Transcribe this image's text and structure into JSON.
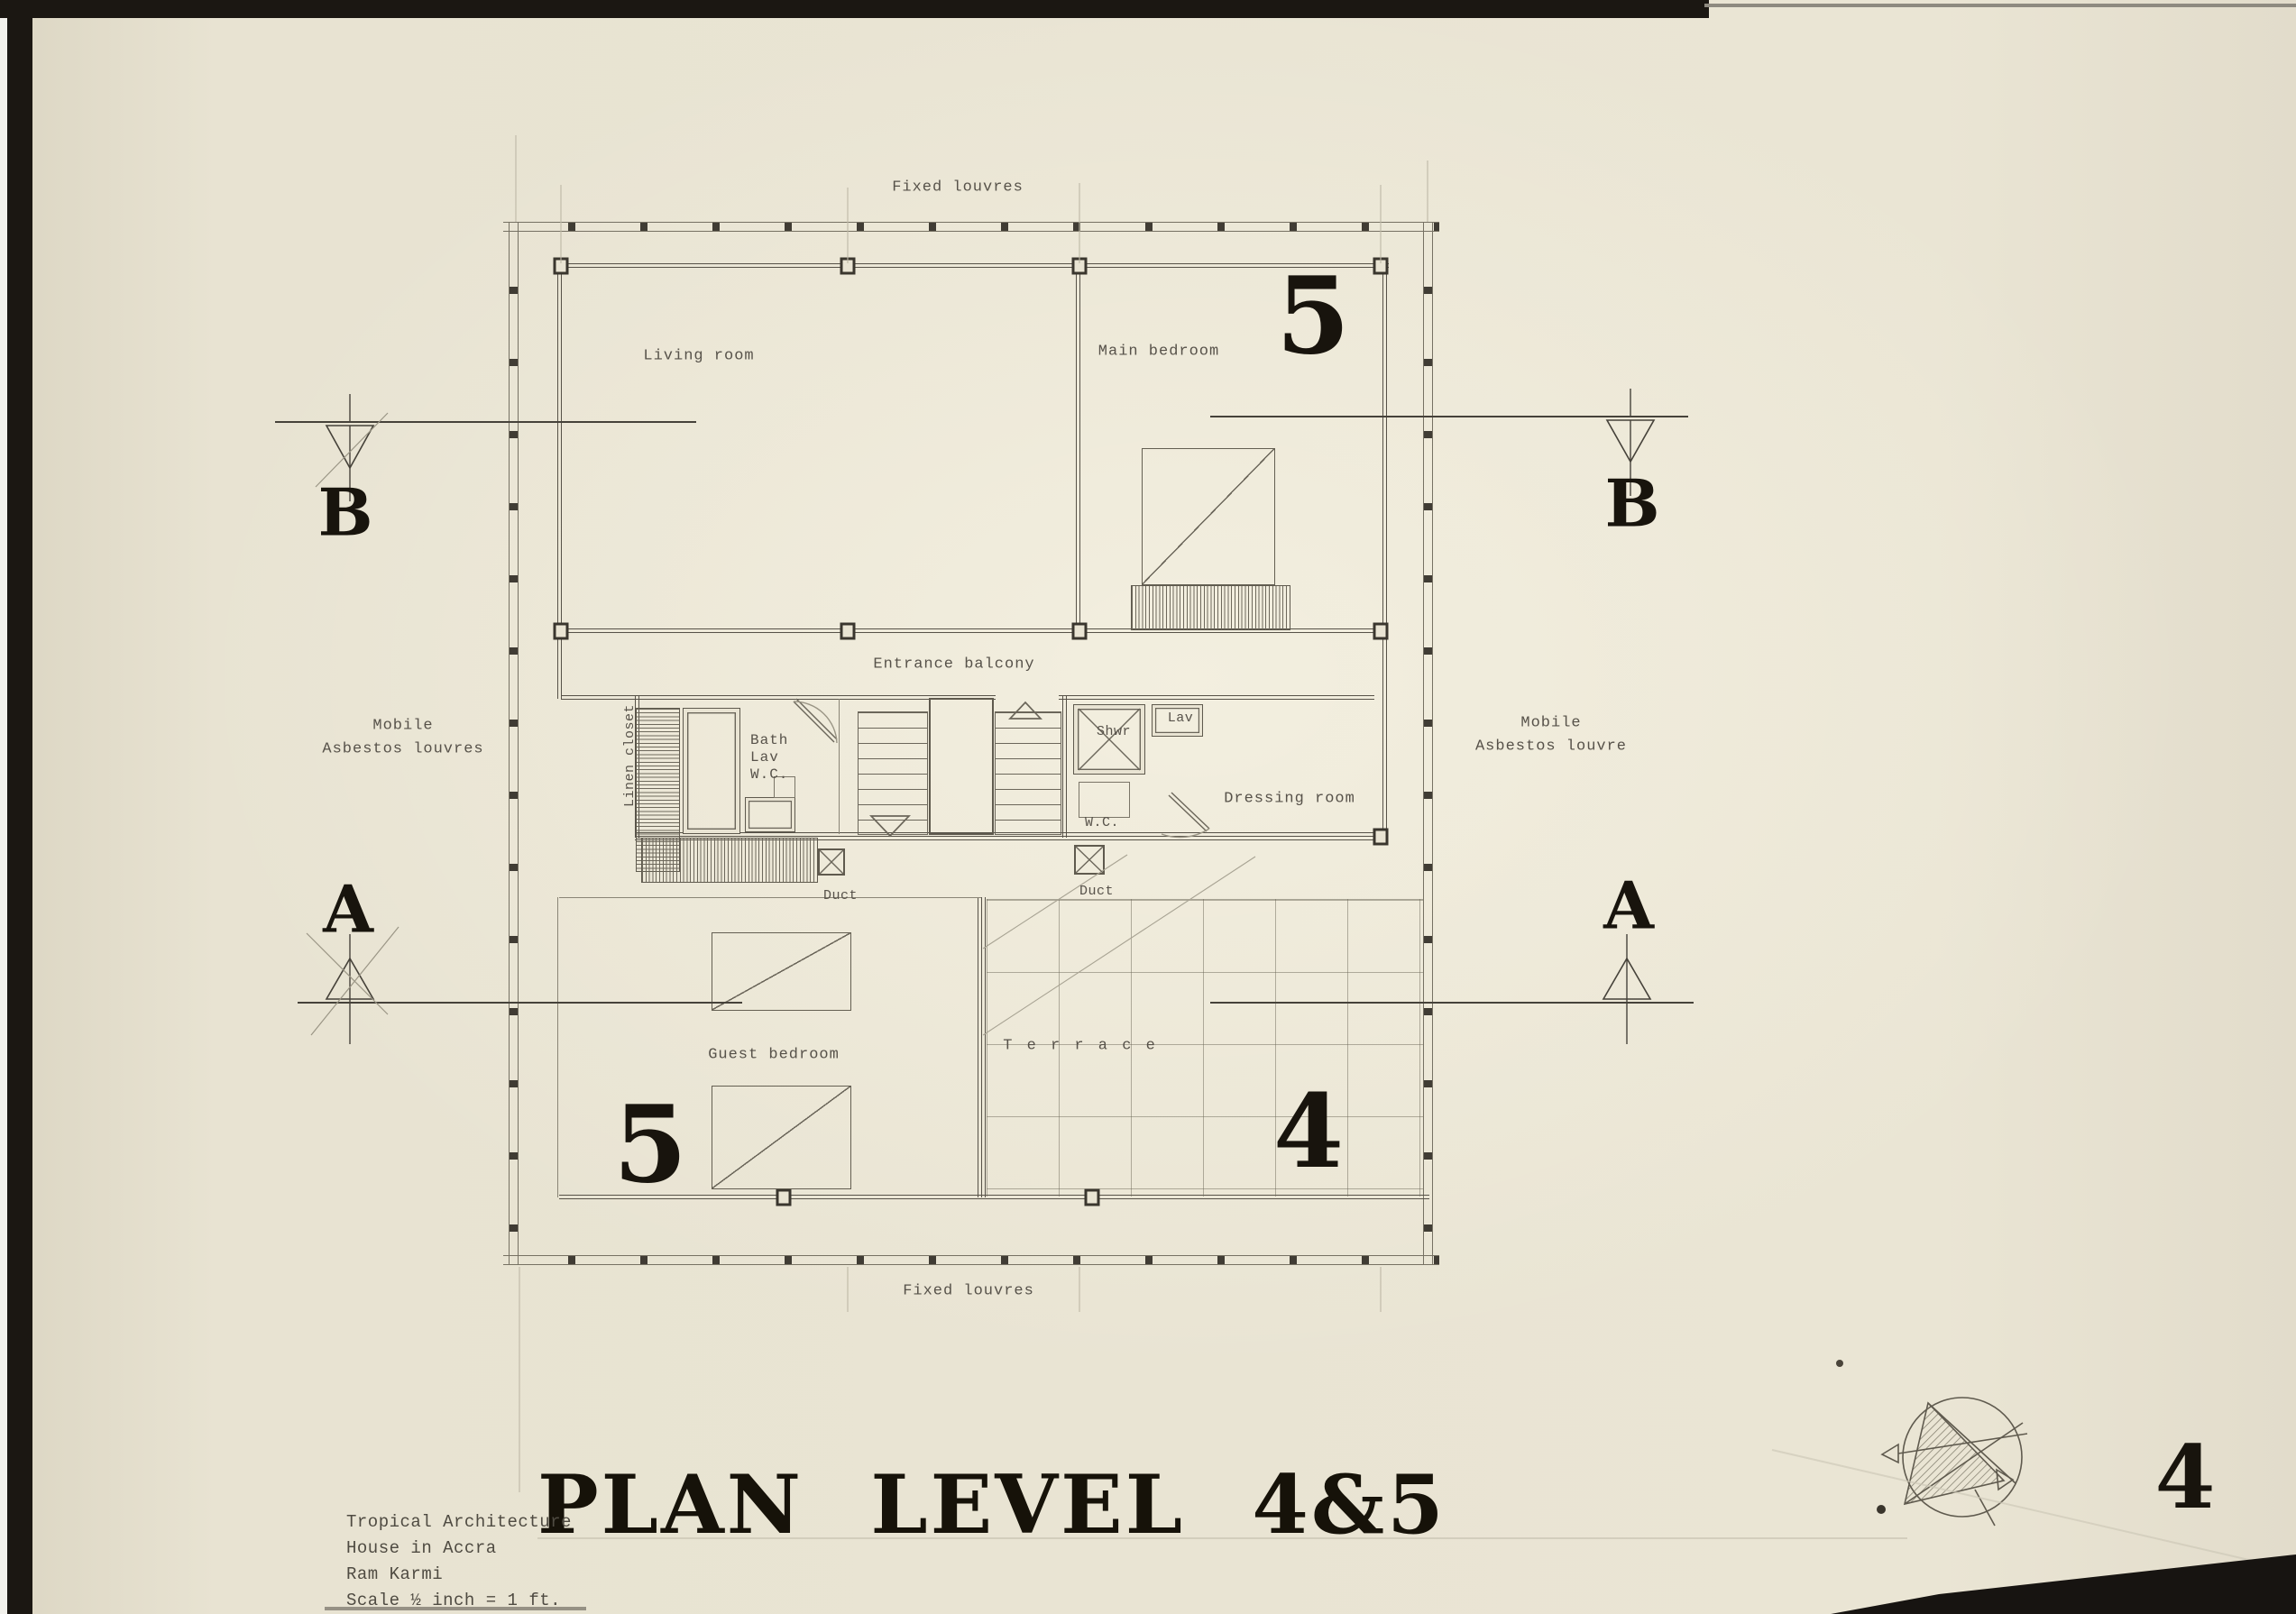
{
  "sheet": {
    "title": "PLAN LEVEL 4&5",
    "page_number": "4",
    "credits": [
      "Tropical Architecture",
      "House in Accra",
      "Ram Karmi",
      "Scale ½ inch = 1 ft."
    ]
  },
  "plan": {
    "louvres": {
      "top": "Fixed louvres",
      "bottom": "Fixed louvres",
      "left": "Mobile\nAsbestos louvres",
      "right": "Mobile\nAsbestos louvre"
    },
    "rooms": {
      "living_room": "Living room",
      "main_bedroom": "Main bedroom",
      "entrance_balcony": "Entrance balcony",
      "linen_closet": "Linen closet",
      "bath": "Bath\nLav\nW.C.",
      "shower": "Shwr",
      "lavatory": "Lav",
      "wc": "W.C.",
      "dressing_room": "Dressing room",
      "duct_left": "Duct",
      "duct_right": "Duct",
      "guest_bedroom": "Guest bedroom",
      "terrace": "T e r r a c e"
    },
    "level_numbers": {
      "upper_right": "5",
      "lower_left": "5",
      "lower_right": "4"
    },
    "section_markers": {
      "b_left": "B",
      "b_right": "B",
      "a_left": "A",
      "a_right": "A"
    }
  }
}
